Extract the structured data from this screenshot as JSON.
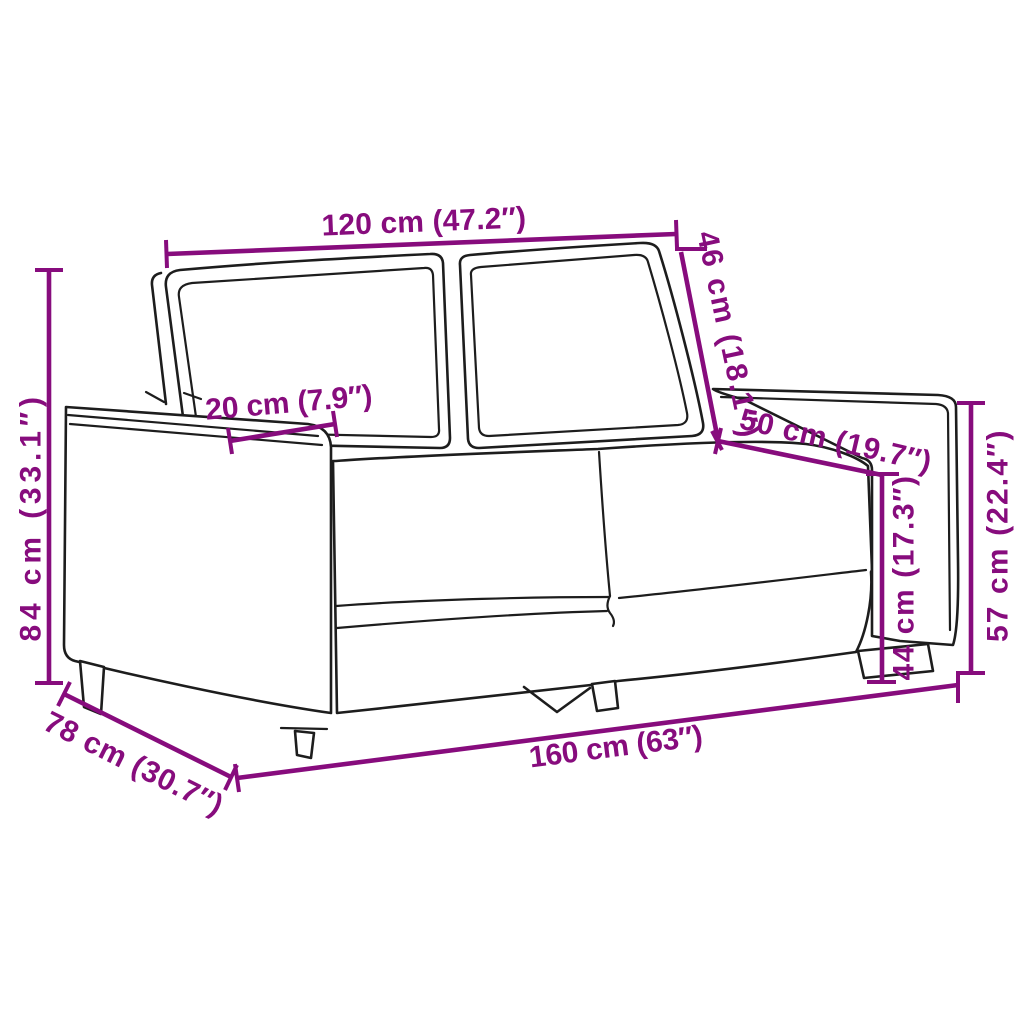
{
  "diagram": {
    "title": "2-seater sofa dimension diagram",
    "background_color": "#ffffff",
    "dimension_color": "#870C7D",
    "art_color": "#1d1d1d",
    "dimensions": [
      {
        "id": "back-width",
        "label": "120 cm (47.2″)",
        "cm": 120,
        "inches": 47.2
      },
      {
        "id": "back-cushion-height",
        "label": "46 cm (18.1″)",
        "cm": 46,
        "inches": 18.1
      },
      {
        "id": "armrest-width",
        "label": "20 cm (7.9″)",
        "cm": 20,
        "inches": 7.9
      },
      {
        "id": "seat-depth",
        "label": "50 cm (19.7″)",
        "cm": 50,
        "inches": 19.7
      },
      {
        "id": "total-height",
        "label": "84 cm (33.1″)",
        "cm": 84,
        "inches": 33.1
      },
      {
        "id": "total-depth",
        "label": "78 cm (30.7″)",
        "cm": 78,
        "inches": 30.7
      },
      {
        "id": "total-width",
        "label": "160 cm (63″)",
        "cm": 160,
        "inches": 63
      },
      {
        "id": "seat-height",
        "label": "44 cm (17.3″)",
        "cm": 44,
        "inches": 17.3
      },
      {
        "id": "armrest-height",
        "label": "57 cm (22.4″)",
        "cm": 57,
        "inches": 22.4
      }
    ]
  }
}
